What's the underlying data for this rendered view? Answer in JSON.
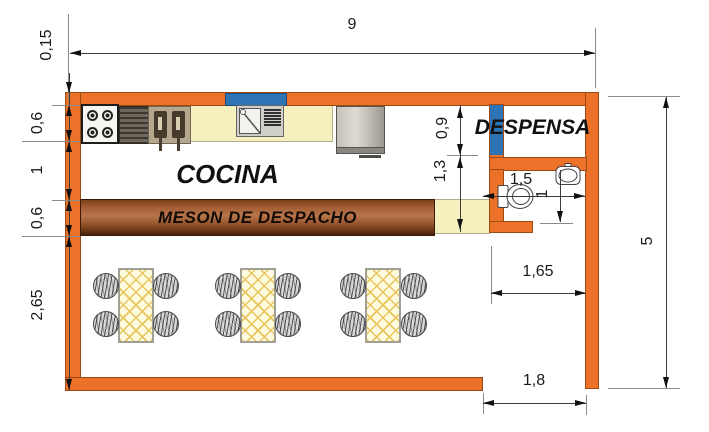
{
  "rooms": {
    "cocina": "COCINA",
    "meson": "MESON DE DESPACHO",
    "despensa": "DESPENSA"
  },
  "dimensions": {
    "total_width": "9",
    "wall_thickness": "0,15",
    "counter_depth": "0,6",
    "kitchen_aisle": "1",
    "meson_depth": "0,6",
    "dining_depth": "2,65",
    "total_height": "5",
    "despensa_door": "0,9",
    "door_to_meson": "1,3",
    "bathroom_width": "1,5",
    "bathroom_depth": "1",
    "bathroom_to_wall": "1,65",
    "entrance_width": "1,8"
  },
  "colors": {
    "wall": "#ED7229",
    "door": "#2E74B5",
    "counter": "#F5F0BE",
    "table": "#FFFBDF",
    "hatch": "#E8C55C"
  }
}
